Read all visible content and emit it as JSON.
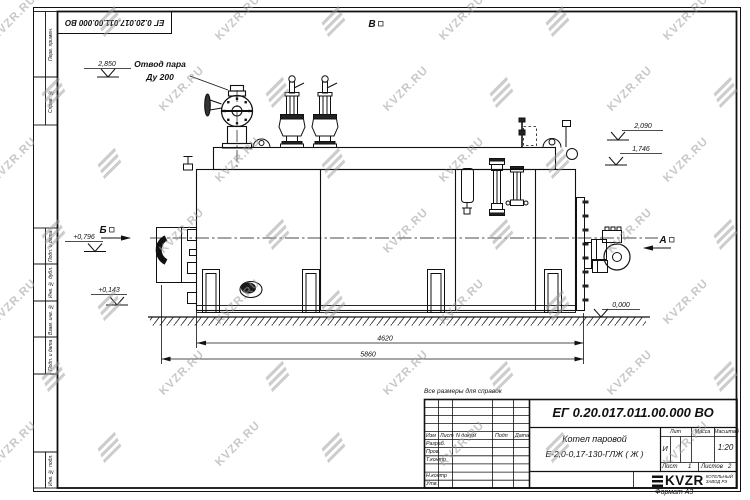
{
  "watermark": {
    "text": "KVZR.RU"
  },
  "top_stamp": {
    "doc_number": "ЕГ 0.20.017.011.00.000  ВО"
  },
  "margin_labels": [
    "Перв. примен.",
    "Справ. №",
    "Подп. и дата",
    "Инв. № дубл.",
    "Взам. инв. №",
    "Подп. и дата",
    "Инв. № подл."
  ],
  "annotations": {
    "steam_outlet_line1": "Отвод пара",
    "steam_outlet_line2": "Ду 200",
    "elev_top": "2,850",
    "elev_right_upper": "2,090",
    "elev_right_lower": "1,746",
    "elev_left_upper": "+0,796",
    "elev_left_lower": "+0,143",
    "elev_ground": "0,000",
    "dim_body": "4620",
    "dim_overall": "5860",
    "view_a": "А",
    "view_b": "Б",
    "view_v": "В"
  },
  "notes": {
    "reference_note": "Все размеры для справок"
  },
  "title_block": {
    "doc_number": "ЕГ 0.20.017.011.00.000  ВО",
    "product_line1": "Котел паровой",
    "product_line2": "Е-2,0-0,17-130-ГЛЖ ( Ж )",
    "col_izm": "Изм",
    "col_list": "Лист",
    "col_ndokum": "N докум",
    "col_podp": "Подп",
    "col_data": "Дата",
    "row_razrab": "Разраб.",
    "row_prov": "Пров.",
    "row_tkontr": "Т.контр",
    "row_nkontr": "Н.контр",
    "row_utv": "Утв.",
    "lit_header": "Лит",
    "massa_header": "Масса",
    "masshtab_header": "Масштаб",
    "lit_value": "И",
    "scale_value": "1:20",
    "sheet_label": "Лист",
    "sheet_value": "1",
    "sheets_label": "Листов",
    "sheets_value": "2",
    "logo_text": "KVZR",
    "logo_tag1": "КОТЕЛЬНЫЙ",
    "logo_tag2": "ЗАВОД РЭ",
    "format_label": "Формат А3"
  }
}
